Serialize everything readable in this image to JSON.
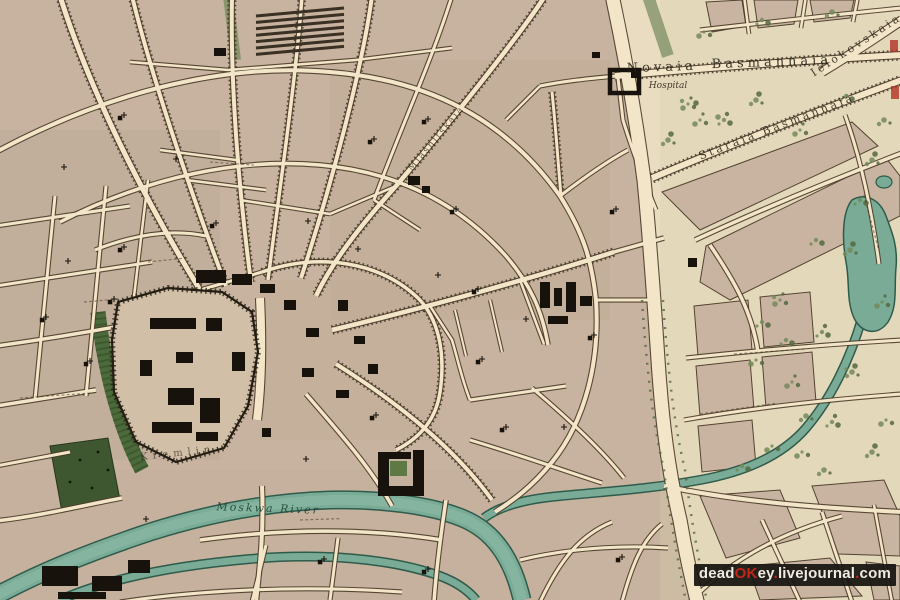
{
  "page": {
    "width": 900,
    "height": 600,
    "kind": "antique-city-map-scan"
  },
  "map": {
    "labels": [
      {
        "id": "novaia",
        "text": "Novaia",
        "x": 662,
        "y": 71,
        "rot": -2,
        "cls": "street-lg"
      },
      {
        "id": "basmannaia",
        "text": "Basmannaia",
        "x": 772,
        "y": 66,
        "rot": -2,
        "cls": "street-lg"
      },
      {
        "id": "hospital",
        "text": "Hospital",
        "x": 668,
        "y": 88,
        "rot": 0,
        "cls": "small-italic"
      },
      {
        "id": "staraia-basmannaia",
        "text": "Staraia Basmannaia",
        "x": 778,
        "y": 130,
        "rot": -21,
        "cls": "street-md"
      },
      {
        "id": "ielokovskaia",
        "text": "Ielokovskaia",
        "x": 858,
        "y": 48,
        "rot": -33,
        "cls": "street-md"
      },
      {
        "id": "miasnitskaia",
        "text": "Miasnitskaia",
        "x": 438,
        "y": 140,
        "rot": -50,
        "cls": "street-sm"
      },
      {
        "id": "moskwa-river",
        "text": "Moskwa  River",
        "x": 268,
        "y": 512,
        "rot": 2,
        "cls": "river"
      },
      {
        "id": "kremlin",
        "text": "Kremlin",
        "x": 178,
        "y": 456,
        "rot": -6,
        "cls": "area"
      }
    ],
    "palette": {
      "parchment": "#e7d8bf",
      "field": "#e9dcc0",
      "block": "#c7b39f",
      "street": "#f3e6c8",
      "outline": "#4b3b29",
      "hatch": "#2e2518",
      "river": "#79ab96",
      "riverEdge": "#2f5b4b",
      "riverLight": "#91bfa9",
      "garden": "#4c6a3b",
      "gardenDark": "#3f5731",
      "tree": "#74895c",
      "treeDark": "#55683f",
      "building": "#17130c",
      "artifactRed": "#b23327"
    }
  },
  "watermark": {
    "parts": [
      {
        "text": "dead",
        "color": "#f0ebe2"
      },
      {
        "text": "OK",
        "color": "#c3251a"
      },
      {
        "text": "ey",
        "color": "#f0ebe2"
      },
      {
        "text": ".",
        "color": "#c3251a"
      },
      {
        "text": "livejournal",
        "color": "#f0ebe2"
      },
      {
        "text": ".",
        "color": "#c3251a"
      },
      {
        "text": "com",
        "color": "#f0ebe2"
      }
    ]
  }
}
